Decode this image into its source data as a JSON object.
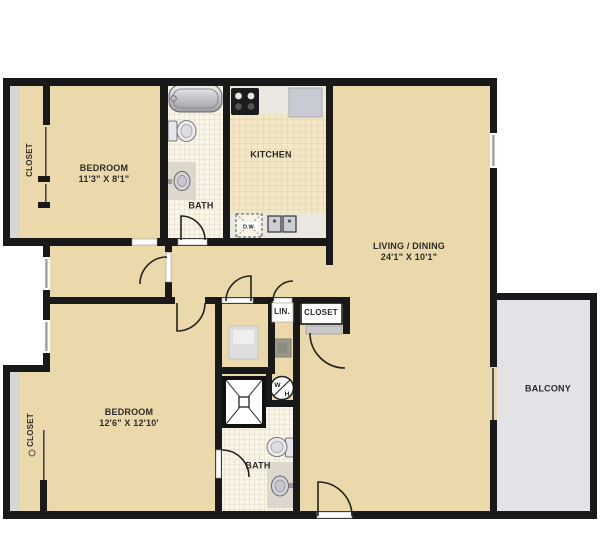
{
  "rooms": {
    "bedroom1": {
      "name": "BEDROOM",
      "dims": "11'3\" X 8'1\""
    },
    "bedroom2": {
      "name": "BEDROOM",
      "dims": "12'6\" X 12'10'"
    },
    "living": {
      "name": "LIVING / DINING",
      "dims": "24'1\" X 10'1\""
    },
    "kitchen": {
      "name": "KITCHEN"
    },
    "bath1": {
      "name": "BATH"
    },
    "bath2": {
      "name": "BATH"
    },
    "linen": {
      "name": "LIN."
    },
    "hall_closet": {
      "name": "CLOSET"
    },
    "closet1": {
      "name": "CLOSET"
    },
    "closet2": {
      "name": "CLOSET"
    },
    "balcony": {
      "name": "BALCONY"
    }
  },
  "fixtures": {
    "water_heater_top": "W",
    "water_heater_bottom": "H",
    "dishwasher": "D.W."
  },
  "colors": {
    "floor_tan": "#ecd9ab",
    "wall_black": "#191919",
    "balcony_gray": "#e3e3e7",
    "closet_strip_gray": "#d6d6d6"
  }
}
